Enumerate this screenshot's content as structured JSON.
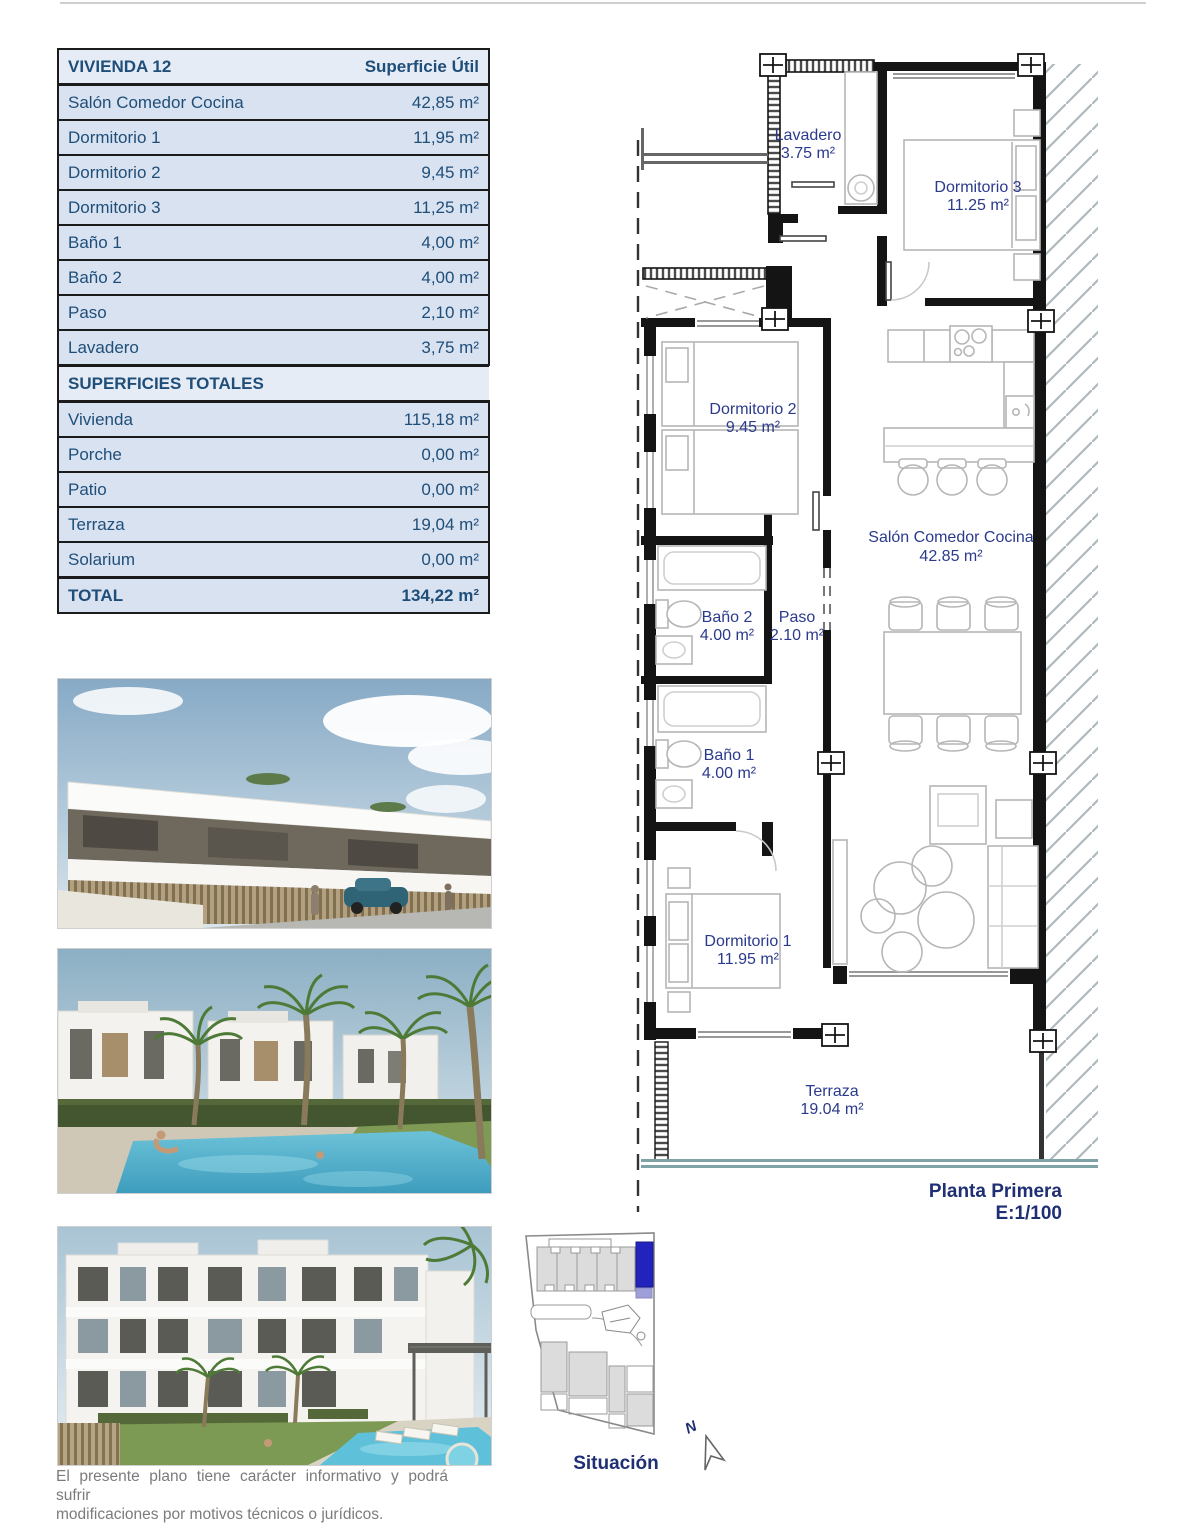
{
  "surface_table": {
    "title": "VIVIENDA 12",
    "header_value": "Superficie Útil",
    "rows": [
      {
        "label": "Salón Comedor Cocina",
        "value": "42,85 m²"
      },
      {
        "label": "Dormitorio 1",
        "value": "11,95 m²"
      },
      {
        "label": "Dormitorio 2",
        "value": "9,45 m²"
      },
      {
        "label": "Dormitorio 3",
        "value": "11,25 m²"
      },
      {
        "label": "Baño 1",
        "value": "4,00 m²"
      },
      {
        "label": "Baño 2",
        "value": "4,00 m²"
      },
      {
        "label": "Paso",
        "value": "2,10 m²"
      },
      {
        "label": "Lavadero",
        "value": "3,75 m²"
      }
    ]
  },
  "totals_table": {
    "title": "SUPERFICIES TOTALES",
    "rows": [
      {
        "label": "Vivienda",
        "value": "115,18 m²"
      },
      {
        "label": "Porche",
        "value": "0,00 m²"
      },
      {
        "label": "Patio",
        "value": "0,00 m²"
      },
      {
        "label": "Terraza",
        "value": "19,04 m²"
      },
      {
        "label": "Solarium",
        "value": "0,00 m²"
      }
    ],
    "total_row": {
      "label": "TOTAL",
      "value": "134,22 m²"
    }
  },
  "floor_plan": {
    "rooms": {
      "lavadero": {
        "name": "Lavadero",
        "area": "3.75 m²"
      },
      "dormitorio3": {
        "name": "Dormitorio 3",
        "area": "11.25 m²"
      },
      "dormitorio2": {
        "name": "Dormitorio 2",
        "area": "9.45 m²"
      },
      "bano2": {
        "name": "Baño 2",
        "area": "4.00 m²"
      },
      "paso": {
        "name": "Paso",
        "area": "2.10 m²"
      },
      "salon": {
        "name": "Salón Comedor Cocina",
        "area": "42.85 m²"
      },
      "bano1": {
        "name": "Baño 1",
        "area": "4.00 m²"
      },
      "dormitorio1": {
        "name": "Dormitorio 1",
        "area": "11.95 m²"
      },
      "terraza": {
        "name": "Terraza",
        "area": "19.04 m²"
      }
    },
    "caption": {
      "line1": "Planta Primera",
      "line2": "E:1/100"
    }
  },
  "site_plan": {
    "label": "Situación",
    "north": "N"
  },
  "disclaimer": {
    "line1": "El presente plano tiene carácter informativo y podrá sufrir",
    "line2": "modificaciones por motivos técnicos o jurídicos."
  },
  "colors": {
    "table_text": "#1f4e79",
    "table_row_bg": "#d9e2f0",
    "plan_text": "#2b3a8c",
    "caption_text": "#1e2f73",
    "highlight_blue": "#2222bd",
    "terrace_edge": "#7fa2a6"
  }
}
